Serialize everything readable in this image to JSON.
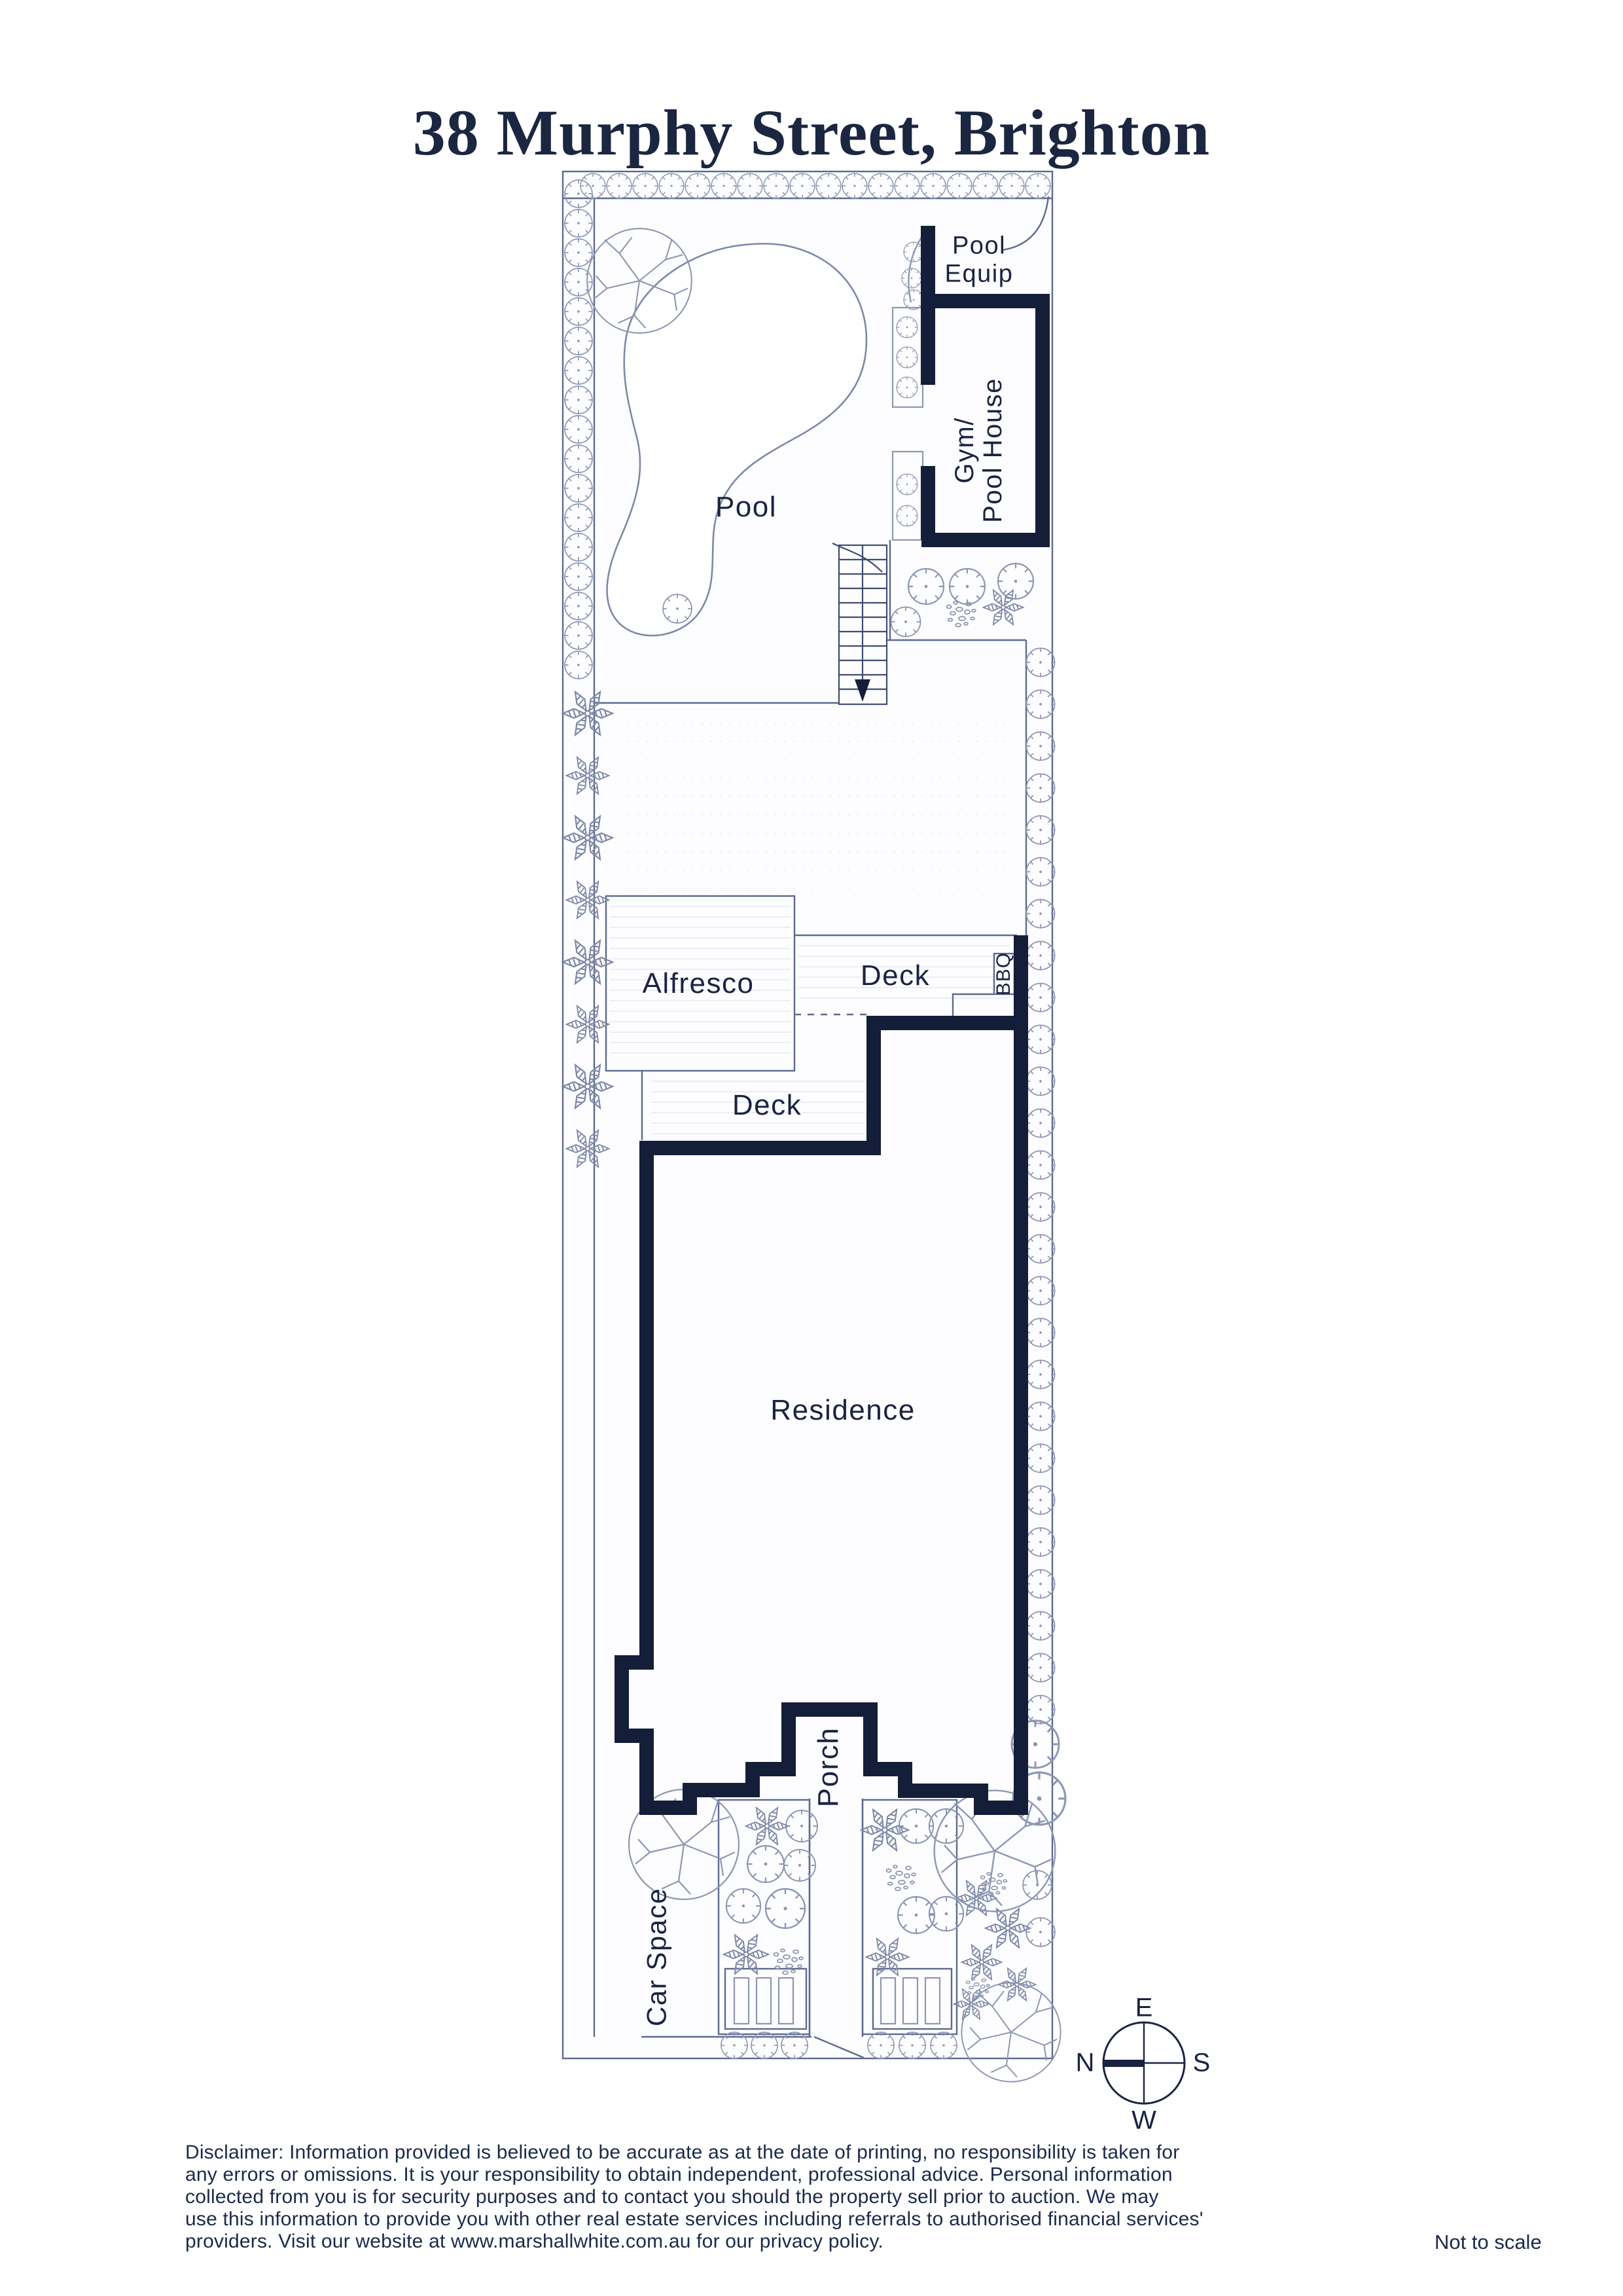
{
  "page": {
    "title": "38 Murphy Street, Brighton",
    "scale_note": "Not to scale"
  },
  "plan": {
    "labels": {
      "pool": "Pool",
      "pool_equip": [
        "Pool",
        "Equip"
      ],
      "gym": [
        "Gym/",
        "Pool House"
      ],
      "alfresco": "Alfresco",
      "deck_upper": "Deck",
      "bbq": "BBQ",
      "deck_lower": "Deck",
      "residence": "Residence",
      "porch": "Porch",
      "car_space": "Car Space"
    },
    "compass": {
      "n": "N",
      "e": "E",
      "s": "S",
      "w": "W"
    }
  },
  "footer": {
    "disclaimer_lines": [
      "Disclaimer: Information provided is believed to be accurate as at the date of printing, no responsibility is taken for",
      "any errors or omissions. It is your responsibility to obtain independent, professional advice. Personal information",
      "collected from you is for security purposes and to contact you should the property sell prior to auction. We may",
      "use this information to provide you with other real estate services including referrals to authorised financial services'",
      "providers. Visit our website at www.marshallwhite.com.au for our privacy policy."
    ]
  },
  "colors": {
    "ink": "#1b2a49",
    "wall": "#141e38",
    "structure_line": "#5d6a8e",
    "vegetation_line": "#8d97b2",
    "pool_line": "#7e89a8"
  }
}
